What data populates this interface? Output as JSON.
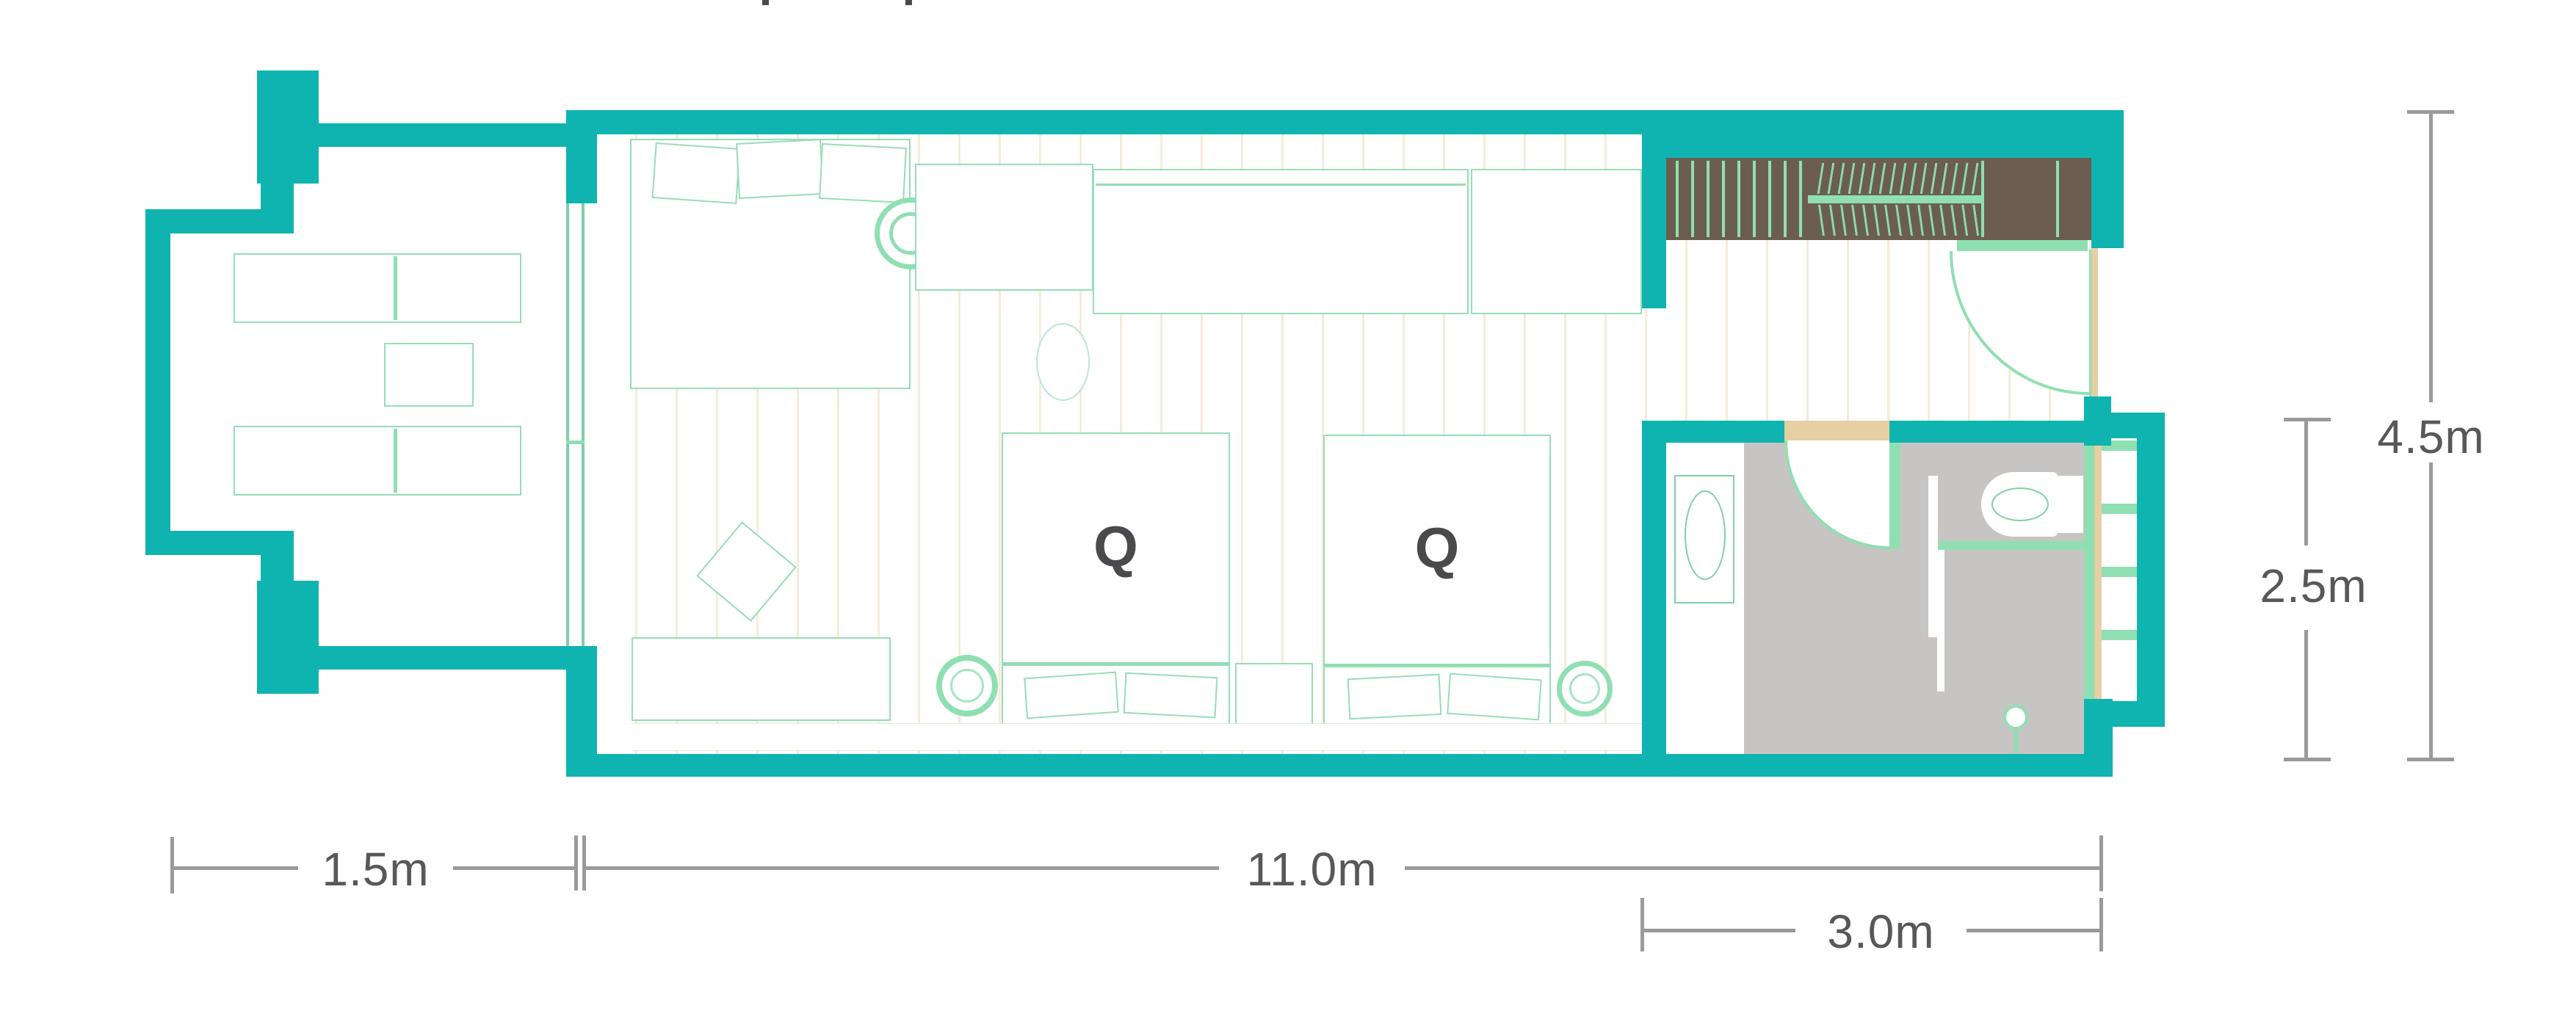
{
  "plan": {
    "bed_labels": [
      "Q",
      "Q"
    ],
    "dimensions": {
      "balcony_depth": "1.5m",
      "room_length": "11.0m",
      "bathroom_width": "3.0m",
      "room_depth": "4.5m",
      "bathroom_depth": "2.5m"
    },
    "colors": {
      "wall_teal": "#0fb4b0",
      "floor_tan": "#e6cfa3",
      "floor_plank_line": "#f6ecd7",
      "accent_green": "#8fdfb2",
      "furniture_outline_green": "#96ddb6",
      "bathroom_floor_gray": "#c7c5c3",
      "closet_brown": "#6b5e51",
      "dimension_gray": "#9a9a9a",
      "label_text": "#57585a",
      "bed_letter": "#4a4a4d"
    }
  }
}
